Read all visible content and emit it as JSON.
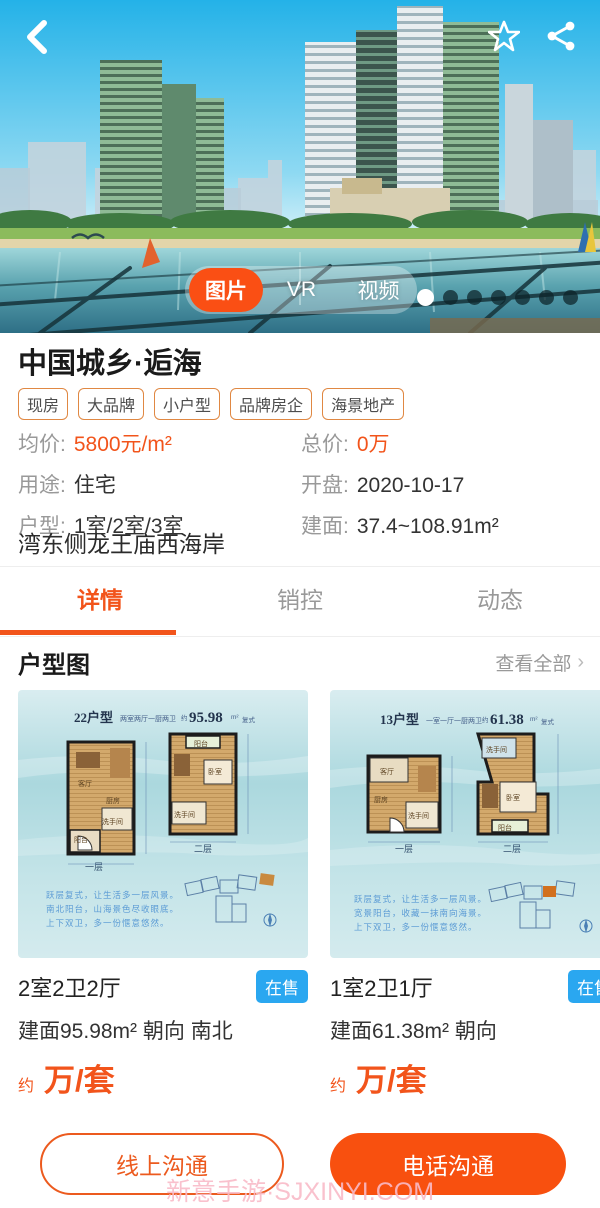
{
  "colors": {
    "accent": "#f2541b",
    "pill_orange": "#fa4f14",
    "badge_blue": "#2aa7f0",
    "tag_border": "#e08843"
  },
  "topbar": {
    "back_icon": "chevron-left",
    "favorite_icon": "star-outline",
    "share_icon": "share-nodes"
  },
  "hero": {
    "media_tabs": [
      {
        "label": "图片",
        "active": true
      },
      {
        "label": "VR",
        "active": false
      },
      {
        "label": "视频",
        "active": false
      }
    ],
    "dots_total": 7,
    "dots_active_index": 0
  },
  "listing": {
    "title": "中国城乡·逅海",
    "tags": [
      "现房",
      "大品牌",
      "小户型",
      "品牌房企",
      "海景地产"
    ],
    "info_left": [
      {
        "label": "均价:",
        "value": "5800元/m²",
        "highlight": true
      },
      {
        "label": "用途:",
        "value": "住宅",
        "highlight": false
      },
      {
        "label": "户型:",
        "value": "1室/2室/3室",
        "highlight": false
      }
    ],
    "info_right": [
      {
        "label": "总价:",
        "value": "0万",
        "highlight": true
      },
      {
        "label": "开盘:",
        "value": "2020-10-17",
        "highlight": false
      },
      {
        "label": "建面:",
        "value": "37.4~108.91m²",
        "highlight": false
      }
    ],
    "address": "湾东侧龙王庙西海岸"
  },
  "nav": {
    "tabs": [
      {
        "label": "详情",
        "active": true
      },
      {
        "label": "销控",
        "active": false
      },
      {
        "label": "动态",
        "active": false
      }
    ]
  },
  "section": {
    "title": "户型图",
    "see_all": "查看全部",
    "chevron": "›"
  },
  "cards": [
    {
      "header": {
        "unit": "22户型",
        "desc": "两室两厅一厨两卫",
        "approx": "约",
        "area": "95.98",
        "area_unit": "m²",
        "suffix": "复式"
      },
      "plan": {
        "floor1": "一层",
        "floor2": "二层",
        "rooms1a": "客厅",
        "rooms1b": "厨房",
        "rooms1c": "洗手间",
        "rooms1d": "阳台",
        "rooms2a": "阳台",
        "rooms2b": "卧室",
        "rooms2c": "洗手间"
      },
      "desc_lines": [
        "跃层复式，让生活多一层风景。",
        "南北阳台，山海景色尽收眼底。",
        "上下双卫，多一份惬意悠然。"
      ],
      "info": {
        "rooms": "2室2卫2厅",
        "badge": "在售",
        "area_line": "建面95.98m² 朝向 南北",
        "price_prefix": "约",
        "price": "万/套"
      }
    },
    {
      "header": {
        "unit": "13户型",
        "desc": "一室一厅一厨两卫",
        "approx": "约",
        "area": "61.38",
        "area_unit": "m²",
        "suffix": "复式"
      },
      "plan": {
        "floor1": "一层",
        "floor2": "二层",
        "rooms1a": "客厅",
        "rooms1b": "厨房",
        "rooms1c": "洗手间",
        "rooms1d": "",
        "rooms2a": "洗手间",
        "rooms2b": "卧室",
        "rooms2c": "阳台"
      },
      "desc_lines": [
        "跃层复式，让生活多一层风景。",
        "宽景阳台，收藏一抹南向海景。",
        "上下双卫，多一份惬意悠然。"
      ],
      "info": {
        "rooms": "1室2卫1厅",
        "badge": "在售",
        "area_line": "建面61.38m² 朝向",
        "price_prefix": "约",
        "price": "万/套"
      }
    }
  ],
  "footer": {
    "online_label": "线上沟通",
    "phone_label": "电话沟通"
  },
  "watermark": "新意手游·SJXINYI.COM"
}
